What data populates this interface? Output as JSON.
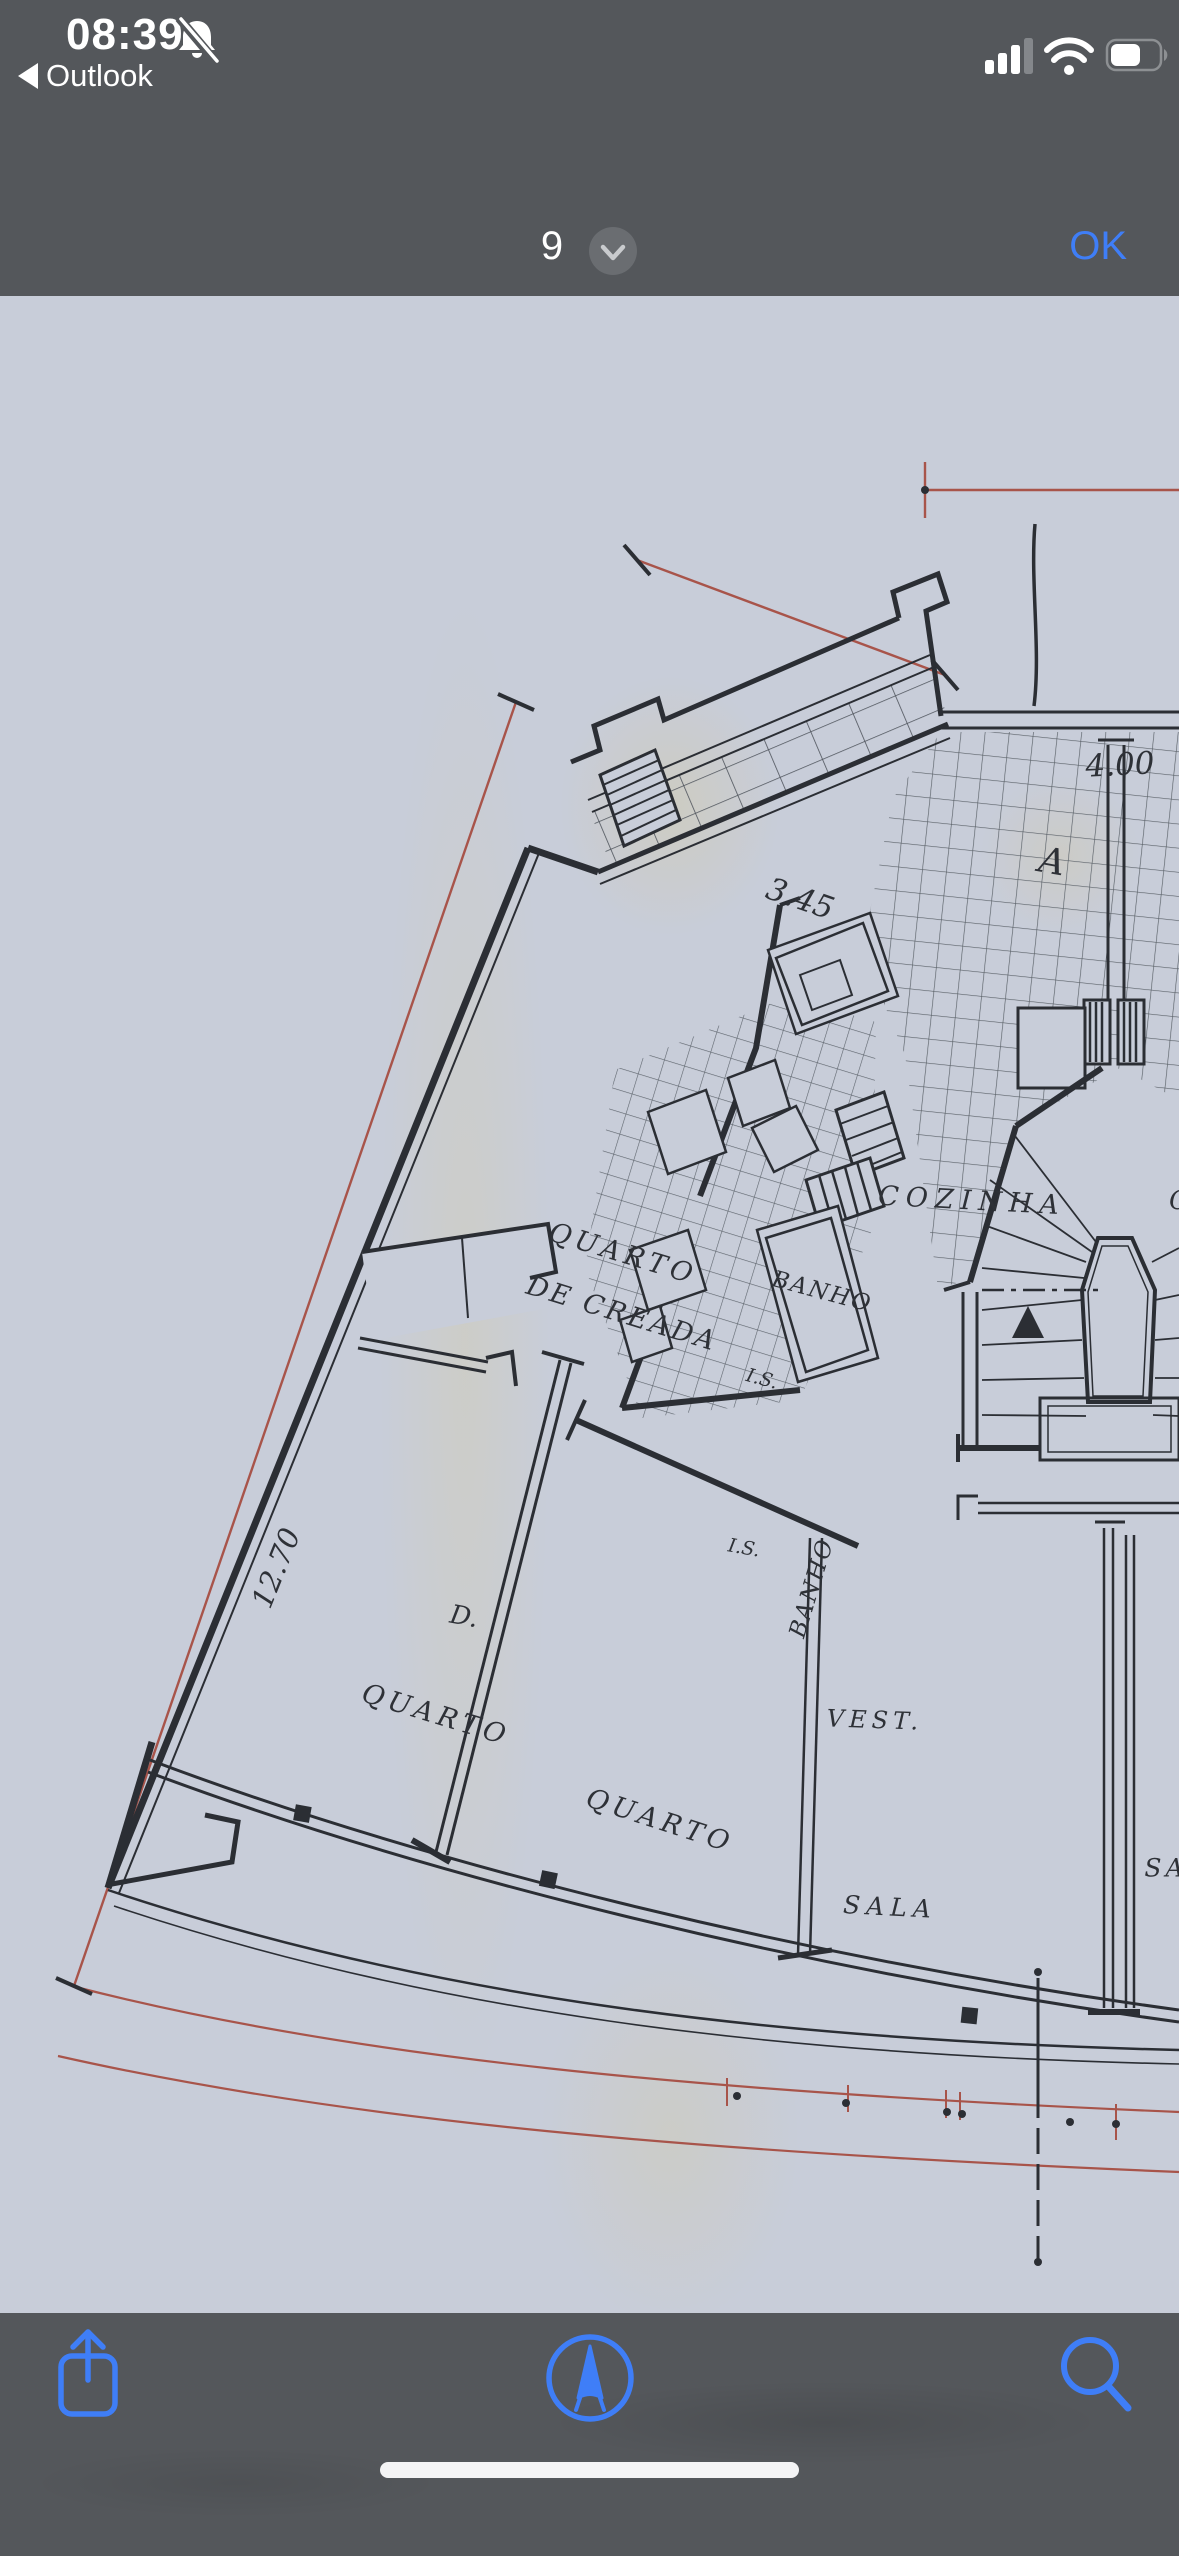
{
  "status_bar": {
    "time": "08:39",
    "back_label": "Outlook"
  },
  "nav_bar": {
    "page_indicator": "9",
    "confirm_label": "OK"
  },
  "plan": {
    "title": "PLANTA DOS ANDARES",
    "rooms": {
      "maid_room_line1": "QUARTO",
      "maid_room_line2": "DE CREADA",
      "kitchen": "COZINHA",
      "kitchen_neighbor_partial": "C",
      "bath_top": "BANHO",
      "bath_mid": "BANHO",
      "wc_top": "I.S.",
      "wc_mid": "I.S.",
      "closet": "D.",
      "bedroom_left": "QUARTO",
      "bedroom_mid": "QUARTO",
      "vestibule": "VEST.",
      "living": "SALA",
      "living_neighbor_partial": "SA"
    },
    "dims": {
      "top": "4.00",
      "upper_diag": "3.45",
      "left": "12.70",
      "bottom": "6.615",
      "s1": "1.525",
      "s2": "1.10",
      "s2_note": "a/c",
      "s3": "1.10",
      "s4": "0.50",
      "s5_partial": "1",
      "development": "DESENVOLV. 20.98",
      "dev_partial": "R"
    },
    "markers": {
      "section_a": "A",
      "section_b": "B"
    }
  },
  "toolbar": {
    "share_icon": "share",
    "markup_icon": "markup-pen",
    "search_icon": "search"
  },
  "colors": {
    "accent_blue": "#3f7ef7",
    "bar_gray": "#54575b",
    "paper": "#c8cdd9",
    "ink": "#2b2e34",
    "dim_red": "#a8544a"
  }
}
